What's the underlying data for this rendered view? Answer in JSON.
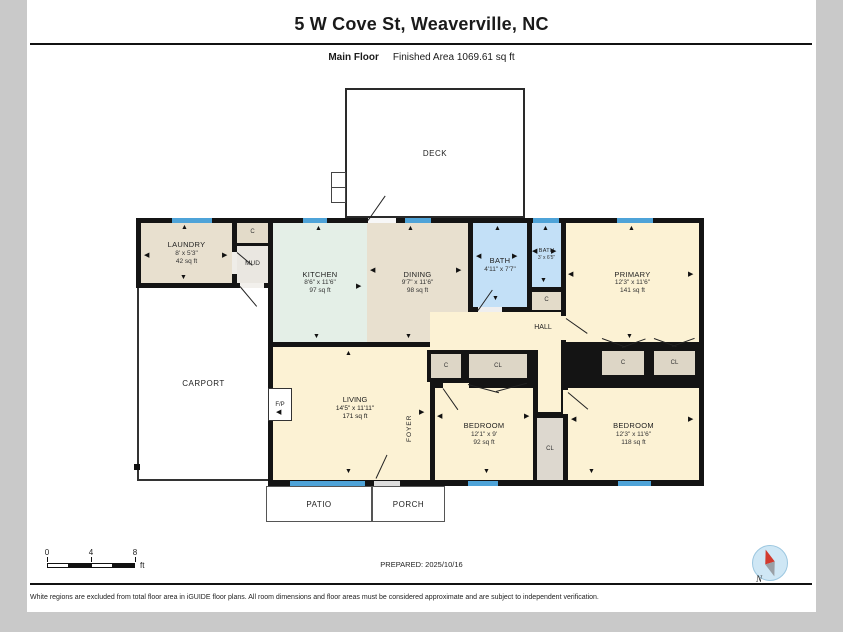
{
  "header": {
    "title": "5 W Cove St, Weaverville, NC",
    "floor_label": "Main Floor",
    "area_label": "Finished Area 1069.61 sq ft"
  },
  "rooms": {
    "laundry": {
      "name": "LAUNDRY",
      "dims": "8' x 5'3\"",
      "area": "42 sq ft"
    },
    "kitchen": {
      "name": "KITCHEN",
      "dims": "8'6\" x 11'6\"",
      "area": "97 sq ft"
    },
    "dining": {
      "name": "DINING",
      "dims": "9'7\" x 11'6\"",
      "area": "98 sq ft"
    },
    "bath": {
      "name": "BATH",
      "dims": "4'11\" x 7'7\""
    },
    "bath_small": {
      "name": "BATH",
      "dims": "3' x 6'5\""
    },
    "primary": {
      "name": "PRIMARY",
      "dims": "12'3\" x 11'6\"",
      "area": "141 sq ft"
    },
    "living": {
      "name": "LIVING",
      "dims": "14'5\" x 11'11\"",
      "area": "171 sq ft"
    },
    "bedroom1": {
      "name": "BEDROOM",
      "dims": "12'1\" x 9'",
      "area": "92 sq ft"
    },
    "bedroom2": {
      "name": "BEDROOM",
      "dims": "12'3\" x 11'6\"",
      "area": "118 sq ft"
    }
  },
  "labels": {
    "deck": "DECK",
    "carport": "CARPORT",
    "patio": "PATIO",
    "porch": "PORCH",
    "mud": "MUD",
    "hall": "HALL",
    "foyer": "FOYER",
    "fireplace": "F/P",
    "closet": "C",
    "closet_long": "CL"
  },
  "scale_bar": {
    "ticks": [
      "0",
      "4",
      "8"
    ],
    "unit": "ft"
  },
  "prepared": "PREPARED: 2025/10/16",
  "disclaimer": "White regions are excluded from total floor area in iGUIDE floor plans. All room dimensions and floor areas must be considered approximate and are subject to independent verification.",
  "compass": {
    "label": "N"
  },
  "colors": {
    "wall": "#141414",
    "window_blue": "#4ea3d8",
    "bath_blue": "#c3e0f7",
    "room_yellow": "#fcf2d4",
    "room_beige": "#e8e0cf",
    "kitchen_mint": "#e4efe7",
    "closet_fill": "#ddd6c6",
    "page_margin_gray": "#c9c9c9"
  }
}
